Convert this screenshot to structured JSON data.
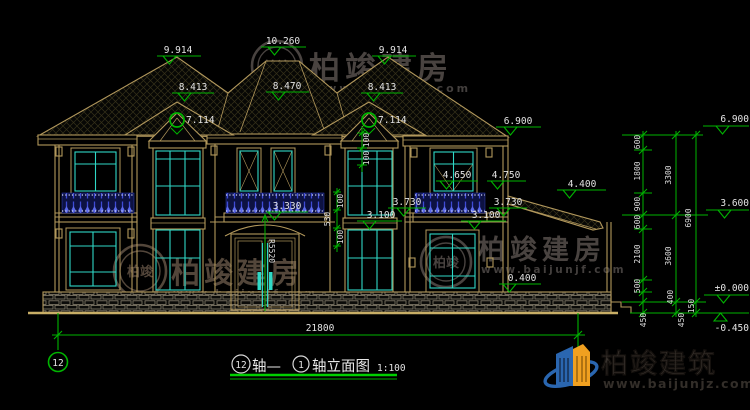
{
  "drawing": {
    "marks": {
      "ridge_left": "9.914",
      "ridge_center": "10.260",
      "ridge_right": "9.914",
      "gable_left": "8.413",
      "gable_center": "8.470",
      "gable_right": "8.413",
      "turret_left": "7.114",
      "turret_right": "7.114",
      "eave_right": "6.900",
      "porch_roof": "4.400",
      "window_sill": "4.650",
      "window_head": "4.750",
      "rail_left": "3.730",
      "rail_right": "3.730",
      "balcony_center": "3.330",
      "slab_left": "3.100",
      "slab_right": "3.100",
      "plinth": "0.400"
    },
    "details": {
      "d100": "100",
      "d530": "530",
      "door_radius": "R5520"
    },
    "total_width": "21800",
    "axis_bubble": "12",
    "chain": {
      "col1": [
        "600",
        "1800",
        "900",
        "600",
        "2100",
        "500",
        "450"
      ],
      "col2": [
        "3300",
        "3600",
        "400",
        "450"
      ],
      "col3": [
        "6900",
        "150"
      ],
      "levels": [
        "6.900",
        "3.600",
        "±0.000",
        "-0.450"
      ]
    },
    "title": {
      "axis_from": "12",
      "connector": "轴—",
      "axis_to": "1",
      "name": "轴立面图",
      "scale": "1:100"
    }
  },
  "watermark": {
    "brand": "柏竣建房",
    "url": "www.baijunjf.com",
    "monogram": "柏竣"
  },
  "logo": {
    "brand": "柏竣建筑",
    "url": "www.baijunjz.com"
  },
  "colors": {
    "line_tan": "#b2985c",
    "dim_green": "#00b400",
    "window_cyan": "#2fd8c6",
    "rail_blue": "#3e4bd6",
    "watermark_gray": "#4c4643"
  }
}
